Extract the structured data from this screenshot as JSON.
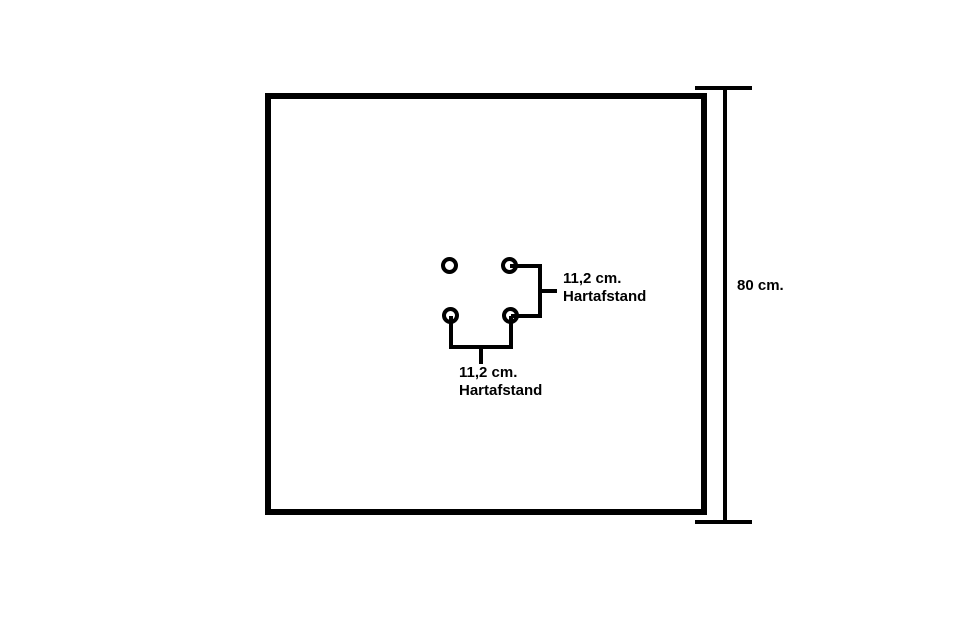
{
  "diagram": {
    "background_color": "#ffffff",
    "line_color": "#000000",
    "panel": {
      "height_label": "80 cm."
    },
    "hole_pattern": {
      "hole_count": 4,
      "vertical_spacing": {
        "value": "11,2 cm.",
        "caption": "Hartafstand"
      },
      "horizontal_spacing": {
        "value": "11,2 cm.",
        "caption": "Hartafstand"
      }
    }
  }
}
